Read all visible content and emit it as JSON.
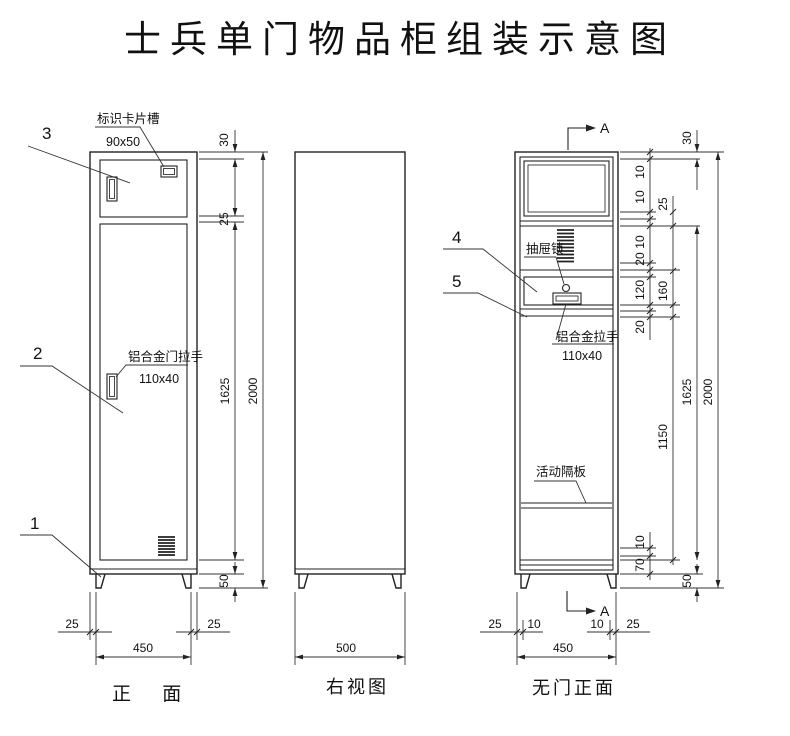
{
  "title": "士兵单门物品柜组装示意图",
  "front_view": {
    "caption": "正 面",
    "part_labels": {
      "p1": "1",
      "p2": "2",
      "p3": "3"
    },
    "card_slot_label": "标识卡片槽",
    "card_slot_size": "90x50",
    "door_handle_label": "铝合金门拉手",
    "door_handle_size": "110x40",
    "dims": {
      "top_inset": "30",
      "door_gap": "25",
      "door_height": "1625",
      "total_height": "2000",
      "leg_height": "50",
      "left_inset": "25",
      "base_width": "450",
      "right_inset": "25"
    }
  },
  "side_view": {
    "caption": "右视图",
    "dims": {
      "depth": "500"
    }
  },
  "open_view": {
    "caption": "无门正面",
    "section_mark": "A",
    "part_labels": {
      "p4": "4",
      "p5": "5"
    },
    "drawer_lock_label": "抽屉锁",
    "drawer_handle_label": "铝合金拉手",
    "drawer_handle_size": "110x40",
    "shelf_label": "活动隔板",
    "dims": {
      "top_inset": "30",
      "t10a": "10",
      "t10b": "10",
      "t10c": "10",
      "t25": "25",
      "t20a": "20",
      "t120": "120",
      "t160": "160",
      "t20b": "20",
      "mid_height": "1150",
      "door_height": "1625",
      "total_height": "2000",
      "b10": "10",
      "b70": "70",
      "leg_height": "50",
      "left_inset": "25",
      "l10": "10",
      "r10": "10",
      "right_inset": "25",
      "base_width": "450"
    }
  }
}
